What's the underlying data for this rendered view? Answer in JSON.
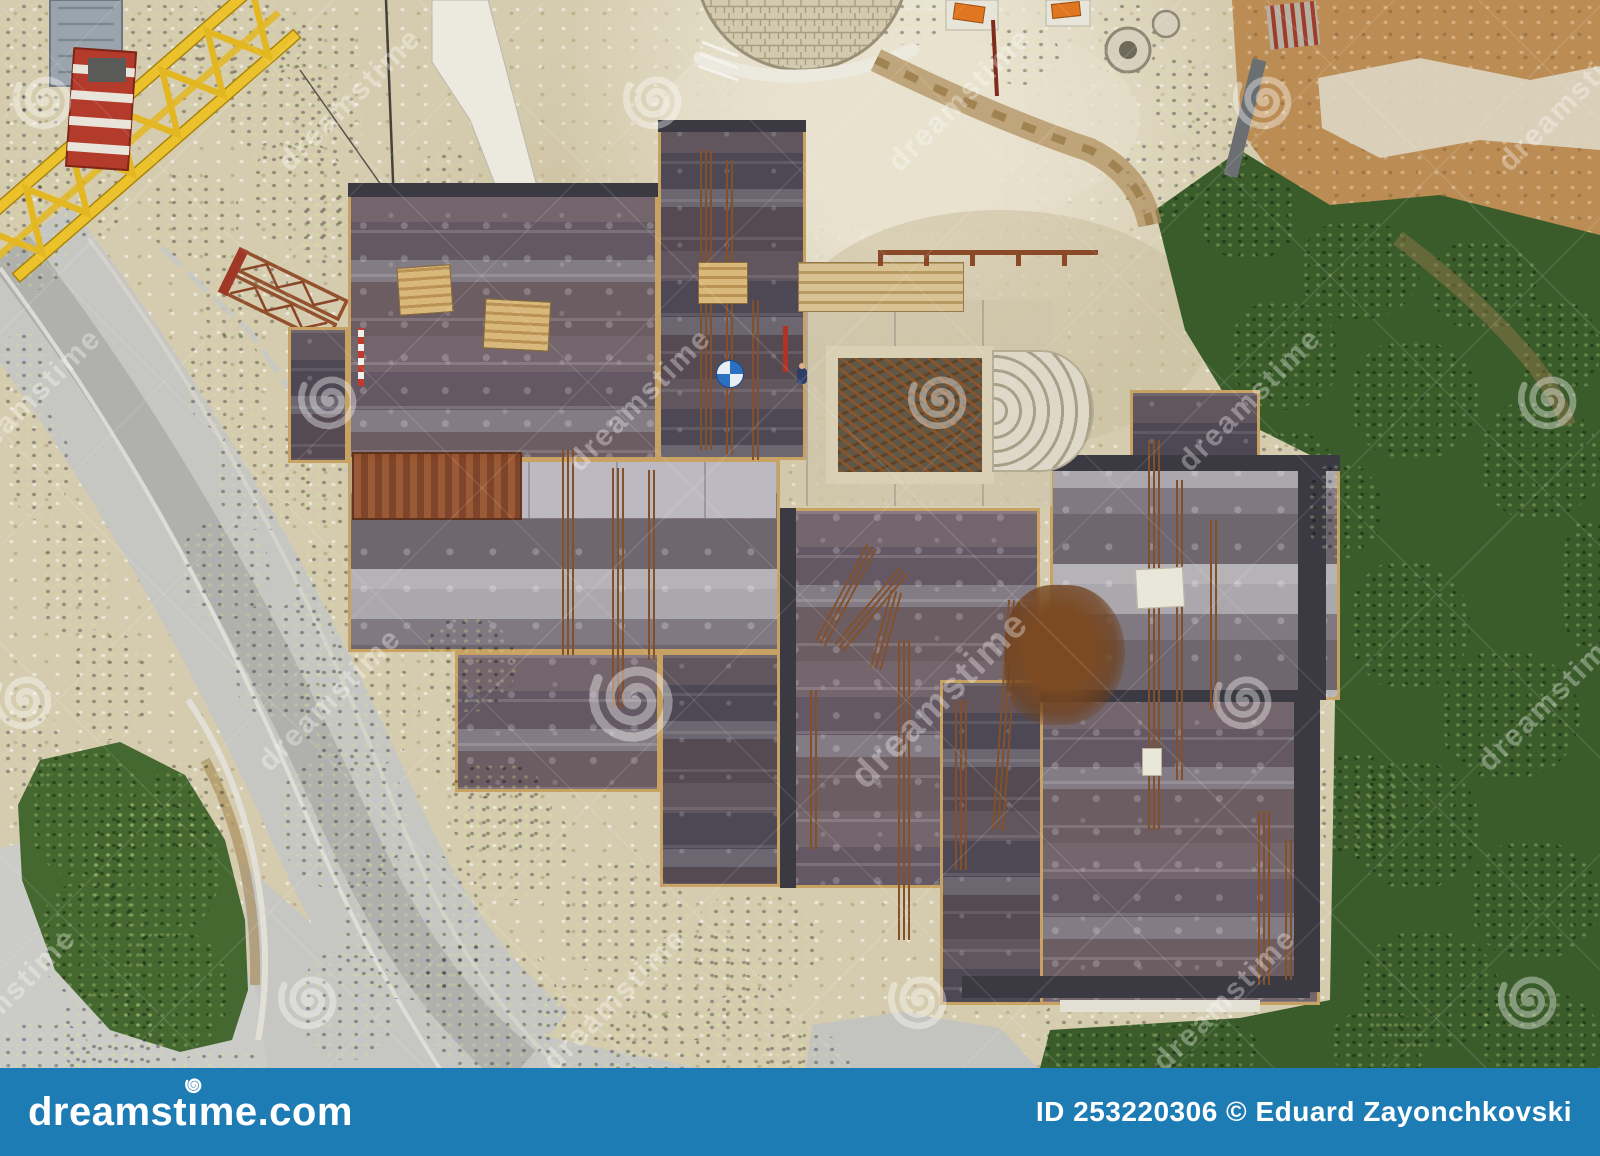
{
  "watermark": {
    "text": "dreamstime",
    "symbol": "©",
    "text_color": "rgba(255,255,255,0.33)"
  },
  "footer": {
    "bar_color": "#1e7cb4",
    "brand": "dreamstime.com",
    "brand_parts": {
      "left": "dreamst",
      "i": "ı",
      "right": "me.com"
    },
    "credit": "ID 253220306 © Eduard Zayonchkovski"
  },
  "palette": {
    "sand": "#d5ccb0",
    "dirt": "#bb8d55",
    "road": "#c6c6c2",
    "foliage_dark": "#2e4d22",
    "foliage_mid": "#48702c",
    "foliage_bright": "#7fa74b",
    "crane_yellow": "#ecc22c",
    "cab_red": "#b23b2c",
    "formwork_dark": "#57505c",
    "formwork_light": "#b7b5b8",
    "wood_beam": "#c7a263",
    "rust": "#8a4f29",
    "concrete": "#d6cdb2"
  }
}
